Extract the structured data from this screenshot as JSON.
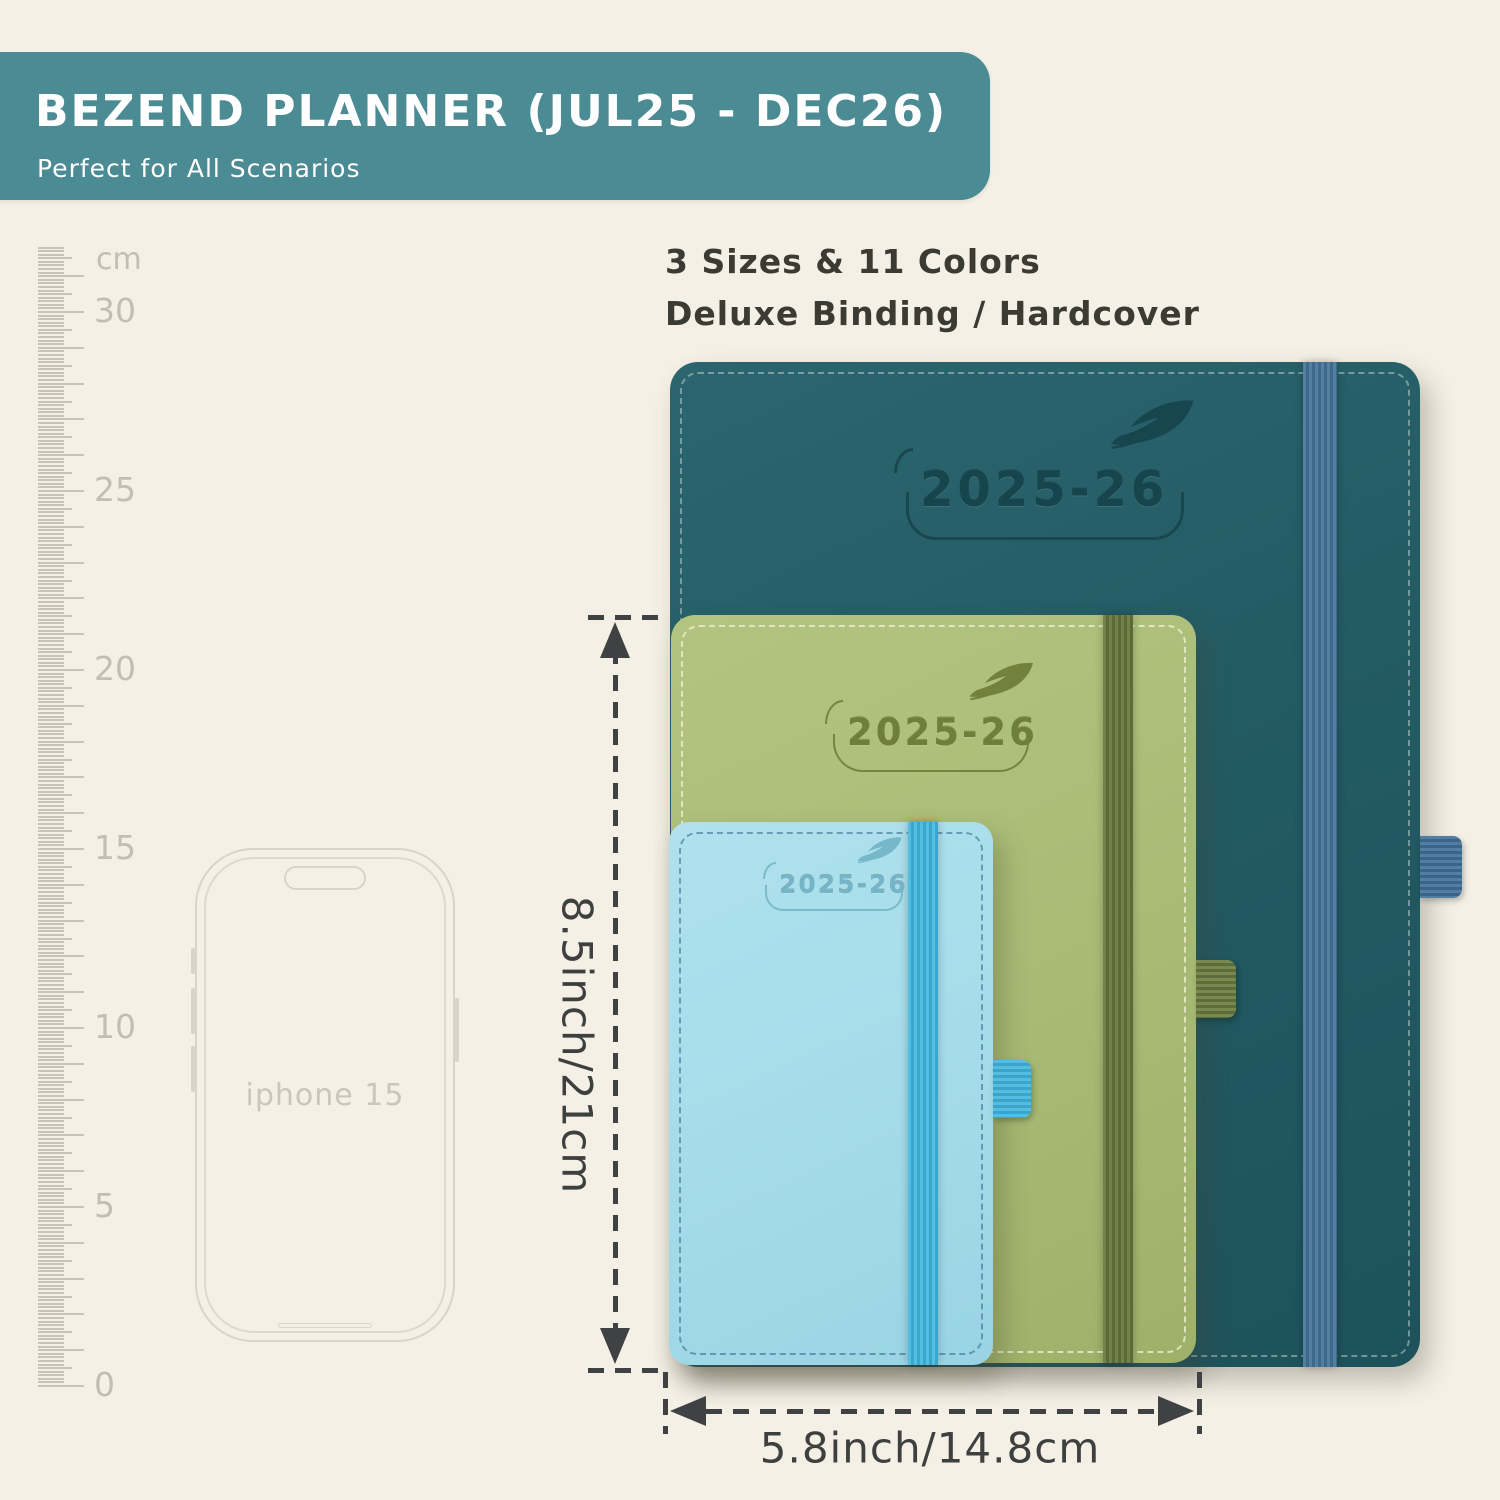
{
  "header": {
    "title": "BEZEND PLANNER (JUL25 - DEC26)",
    "subtitle": "Perfect for All Scenarios",
    "bg_color": "#4b8b94",
    "text_color": "#ffffff"
  },
  "features": {
    "line1": "3 Sizes & 11 Colors",
    "line2": "Deluxe Binding / Hardcover"
  },
  "ruler": {
    "unit": "cm",
    "labels": [
      "30",
      "25",
      "20",
      "15",
      "10",
      "5",
      "0"
    ],
    "label_values_cm": [
      30,
      25,
      20,
      15,
      10,
      5,
      0
    ],
    "tick_color": "#c8c3b6"
  },
  "phone": {
    "label": "iphone 15",
    "outline_color": "#d9d4c8"
  },
  "planners": {
    "large": {
      "year": "2025-26",
      "cover_color": "#235b63",
      "band_color": "#4a7ba2",
      "loop_color": "#40719a"
    },
    "medium": {
      "year": "2025-26",
      "cover_color": "#a9bc76",
      "band_color": "#66763f",
      "loop_color": "#6d7d46"
    },
    "small": {
      "year": "2025-26",
      "cover_color": "#a6dcea",
      "band_color": "#45b4d9",
      "loop_color": "#4ab4d8"
    }
  },
  "dimensions": {
    "height_label": "8.5inch/21cm",
    "width_label": "5.8inch/14.8cm",
    "annotation_color": "#3f4142"
  },
  "background_color": "#f4f0e5"
}
